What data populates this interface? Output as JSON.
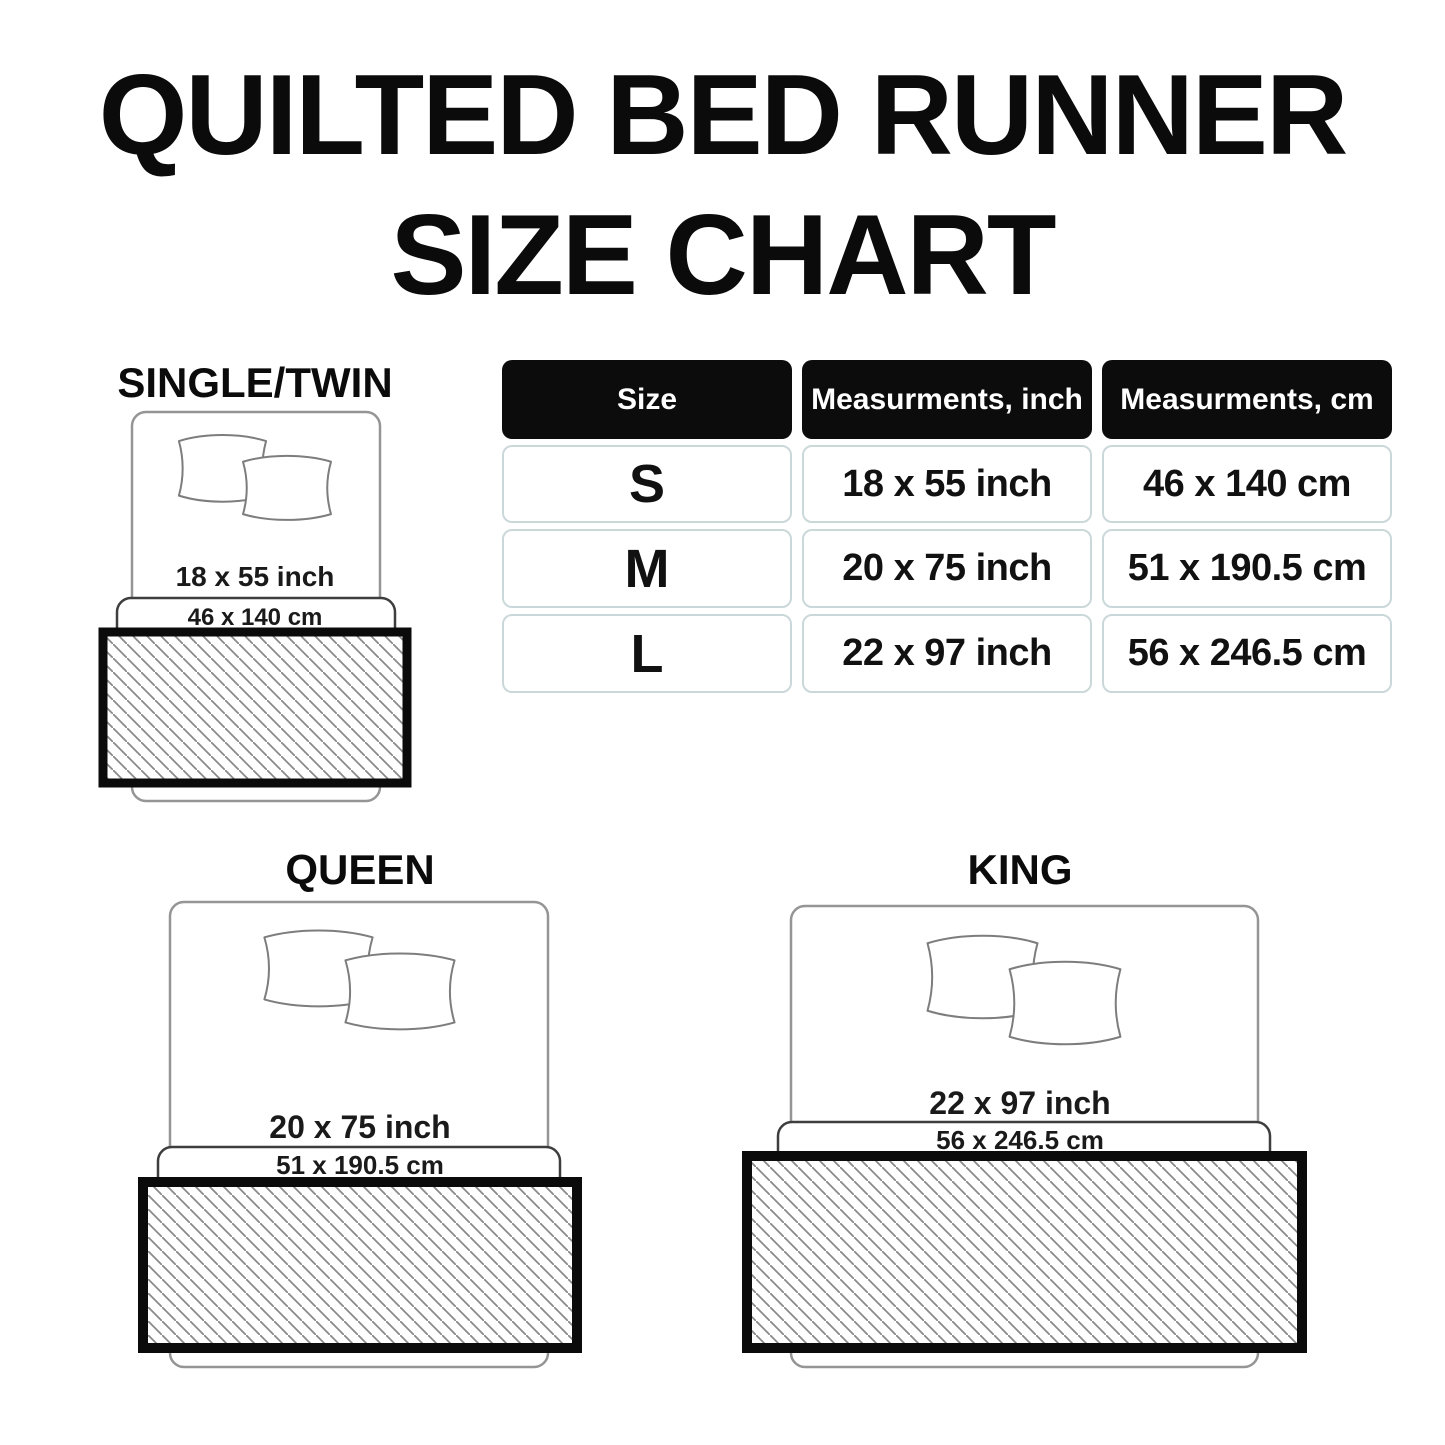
{
  "title": {
    "line1": "QUILTED BED RUNNER",
    "line2": "SIZE CHART"
  },
  "table": {
    "headers": [
      "Size",
      "Measurments, inch",
      "Measurments, cm"
    ],
    "rows": [
      {
        "size": "S",
        "inch": "18 x 55 inch",
        "cm": "46 x 140 cm"
      },
      {
        "size": "M",
        "inch": "20 x 75 inch",
        "cm": "51 x 190.5 cm"
      },
      {
        "size": "L",
        "inch": "22 x 97 inch",
        "cm": "56 x 246.5 cm"
      }
    ]
  },
  "diagrams": {
    "single": {
      "label": "SINGLE/TWIN",
      "inch": "18 x 55 inch",
      "cm": "46 x 140 cm"
    },
    "queen": {
      "label": "QUEEN",
      "inch": "20 x 75 inch",
      "cm": "51 x 190.5 cm"
    },
    "king": {
      "label": "KING",
      "inch": "22 x 97 inch",
      "cm": "56 x 246.5 cm"
    }
  },
  "chart_data": {
    "type": "table",
    "title": "QUILTED BED RUNNER SIZE CHART",
    "columns": [
      "Size",
      "Measurments, inch",
      "Measurments, cm"
    ],
    "rows": [
      [
        "S",
        "18 x 55 inch",
        "46 x 140 cm"
      ],
      [
        "M",
        "20 x 75 inch",
        "51 x 190.5 cm"
      ],
      [
        "L",
        "22 x 97 inch",
        "56 x 246.5 cm"
      ]
    ],
    "size_to_bed": {
      "S": "SINGLE/TWIN",
      "M": "QUEEN",
      "L": "KING"
    }
  },
  "colors": {
    "background": "#ffffff",
    "text": "#0b0b0b",
    "header_bg": "#0c0c0c",
    "header_text": "#ffffff",
    "cell_border": "#cbd8da",
    "bed_outline": "#959595",
    "sheet_outline": "#3e3e3e",
    "pillow_outline": "#7d7d7d",
    "hatch_line": "#8a8a8a",
    "runner_border": "#0b0b0b"
  }
}
